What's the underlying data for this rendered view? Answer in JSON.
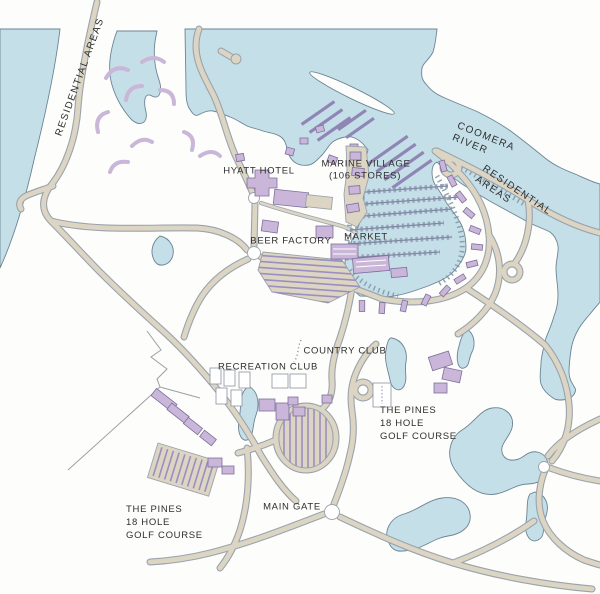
{
  "map": {
    "region_labels": {
      "residential_west": "RESIDENTIAL AREAS",
      "coomera_river": "COOMERA RIVER",
      "residential_east": "RESIDENTIAL AREAS"
    },
    "place_labels": {
      "hyatt": "HYATT HOTEL",
      "marine_village_line1": "MARINE VILLAGE",
      "marine_village_line2": "(106 STORES)",
      "beer_factory": "BEER FACTORY",
      "market": "MARKET",
      "country_club": "COUNTRY CLUB",
      "recreation_club": "RECREATION CLUB",
      "main_gate": "MAIN GATE",
      "pines_east": "THE PINES\n18 HOLE\nGOLF COURSE",
      "pines_west": "THE PINES\n18 HOLE\nGOLF COURSE"
    },
    "colors": {
      "water": "#c5dfe8",
      "shoreline": "#6b8494",
      "land": "#fdfdfb",
      "road_fill": "#ddd5c3",
      "road_edge": "#9aa3ac",
      "building": "#c9b6d8",
      "building_edge": "#7e6f9e",
      "parking_stripe": "#9b8fc0",
      "dock": "#8f86b5",
      "label_text": "#2e2e2e"
    }
  }
}
